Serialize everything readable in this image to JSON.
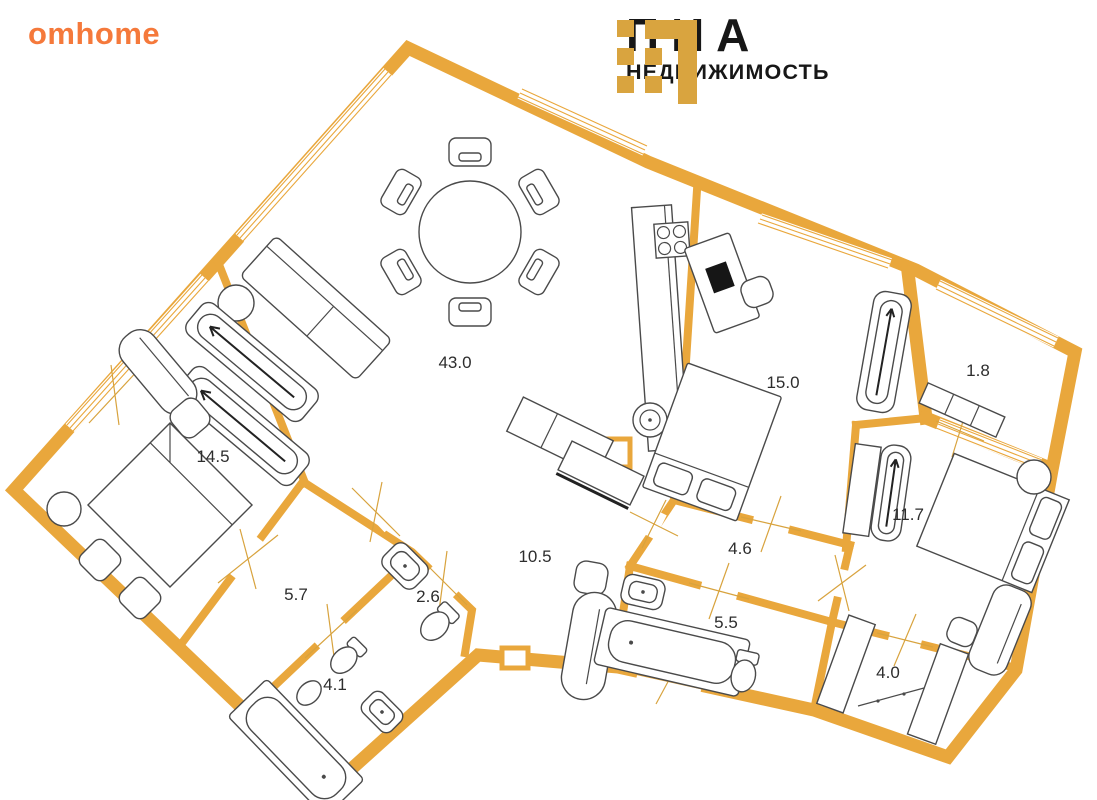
{
  "brand_left": {
    "logo_text": "omhome",
    "color": "#F5793B"
  },
  "brand_right": {
    "title": "ПИА",
    "subtitle": "НЕДВИЖИМОСТЬ",
    "icon": "grid-squares-logo-icon",
    "icon_color": "#D9A43F",
    "text_color": "#171717"
  },
  "floor_plan": {
    "type": "apartment-floor-plan",
    "wall_color": "#E9A73C",
    "furniture_line_color": "#4a4a4a",
    "rooms": [
      {
        "area": "43.0",
        "x": 455,
        "y": 368
      },
      {
        "area": "14.5",
        "x": 213,
        "y": 462
      },
      {
        "area": "15.0",
        "x": 783,
        "y": 388
      },
      {
        "area": "1.8",
        "x": 978,
        "y": 376
      },
      {
        "area": "11.7",
        "x": 908,
        "y": 520
      },
      {
        "area": "10.5",
        "x": 535,
        "y": 562
      },
      {
        "area": "4.6",
        "x": 740,
        "y": 554
      },
      {
        "area": "5.7",
        "x": 296,
        "y": 600
      },
      {
        "area": "2.6",
        "x": 428,
        "y": 602
      },
      {
        "area": "5.5",
        "x": 726,
        "y": 628
      },
      {
        "area": "4.0",
        "x": 888,
        "y": 678
      },
      {
        "area": "4.1",
        "x": 335,
        "y": 690
      }
    ]
  }
}
